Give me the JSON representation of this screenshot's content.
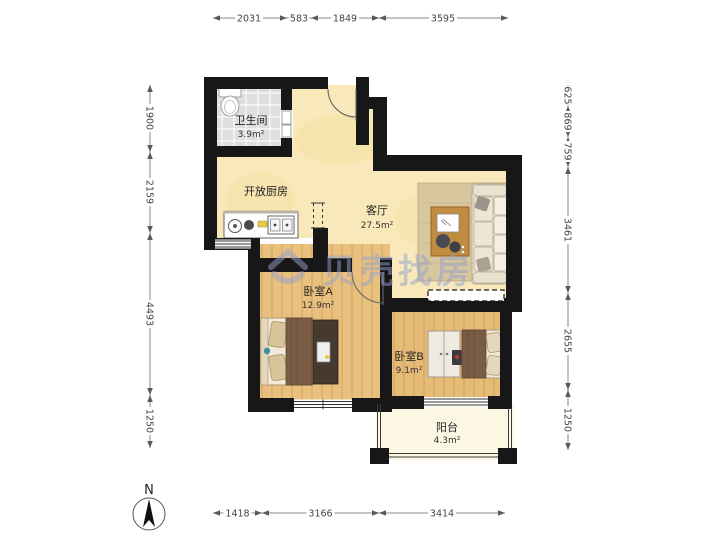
{
  "watermark": {
    "text": "贝壳找房"
  },
  "compass": {
    "label": "N"
  },
  "rooms": {
    "bathroom": {
      "name": "卫生间",
      "area": "3.9m²"
    },
    "kitchen": {
      "name": "开放厨房"
    },
    "living": {
      "name": "客厅",
      "area": "27.5m²"
    },
    "bedroomA": {
      "name": "卧室A",
      "area": "12.9m²"
    },
    "bedroomB": {
      "name": "卧室B",
      "area": "9.1m²"
    },
    "balcony": {
      "name": "阳台",
      "area": "4.3m²"
    }
  },
  "dimensions": {
    "top": [
      "2031",
      "583",
      "1849",
      "3595"
    ],
    "bottom": [
      "1418",
      "3166",
      "3414"
    ],
    "left": [
      "1900",
      "2159",
      "4493",
      "1250"
    ],
    "right": [
      "625",
      "869",
      "759",
      "3461",
      "2655",
      "1250"
    ]
  },
  "colors": {
    "wall": "#171717",
    "floor_living": "#f8e8ba",
    "floor_wood": "#e9c07e",
    "floor_tile": "#dedede",
    "floor_balcony": "#fbf7e3",
    "watermark": "#93a2cf"
  }
}
